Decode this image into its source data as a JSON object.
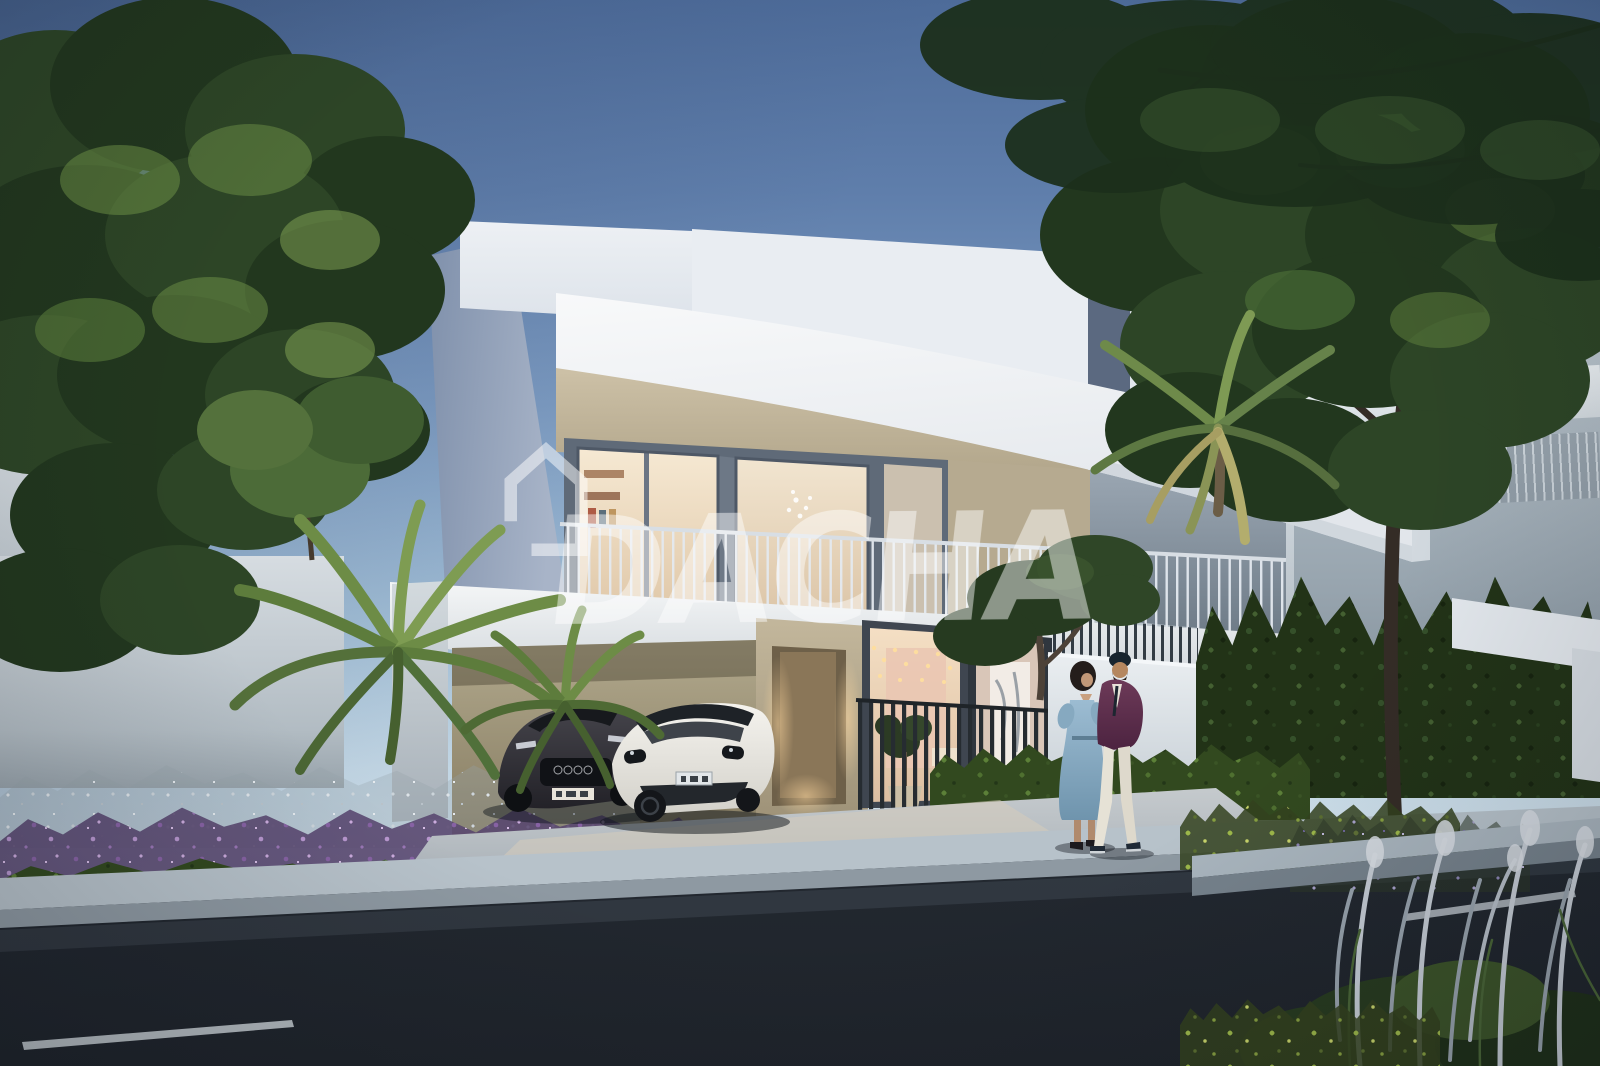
{
  "page": {
    "type": "architectural-rendering-photo",
    "description": "3D rendering of a modern three-storey white villa at dusk with warm lit interiors, a driveway with two parked cars, lush landscaping with purple flower beds and palms, a street in the foreground, large trees framing the scene and a couple walking on the sidewalk"
  },
  "watermark": {
    "logo_icon": "dacha-house-logo-icon",
    "text": "DACHA",
    "color": "#ffffff",
    "opacity": 0.4
  },
  "scene": {
    "time_of_day": "dusk",
    "villa": {
      "storeys": 3,
      "style": "contemporary",
      "features": [
        "stacked white volumes",
        "sweeping curved fascia band",
        "beige stone facade",
        "glass sliding doors with warm interior light",
        "balcony with thin vertical railing",
        "carport under balcony slab",
        "recessed entrance door",
        "string lights at entrance lounge",
        "dark vertical slat fence",
        "white gate wall"
      ]
    },
    "vehicles": [
      {
        "name": "white-sports-car",
        "color": "#efede7",
        "location": "driveway front"
      },
      {
        "name": "dark-grey-car",
        "color": "#35343a",
        "location": "driveway rear"
      }
    ],
    "people": [
      {
        "name": "woman",
        "outfit": "light blue midi dress, dark heels"
      },
      {
        "name": "man",
        "outfit": "plum blazer, white trousers, dark cap, dark shoes"
      }
    ],
    "landscape": [
      "large leafy tree left",
      "large leafy tree right with visible trunk",
      "palm tree right",
      "overhanging fern-like branches top right",
      "palm clusters by driveway",
      "purple flower bed",
      "white feather grasses",
      "clipped green hedges",
      "raised street planter with silver plume grasses"
    ],
    "street": [
      "dark asphalt road",
      "two white lane markings",
      "light concrete curb and sidewalk",
      "neighbouring white villas left and right"
    ]
  },
  "palette": {
    "sky_top": "#4d6b99",
    "sky_horizon": "#d9e7f0",
    "villa_white": "#eef0f3",
    "villa_shaded_side": "#8494ad",
    "facade_beige": "#c9bca2",
    "interior_warm": "#f2e2c6",
    "foliage_dark": "#24391f",
    "foliage_light": "#6f9447",
    "flower_purple": "#a487c0",
    "road_asphalt": "#262d35",
    "pavement": "#aeb9c2",
    "dress_blue": "#8fb2c8",
    "blazer_plum": "#5f2f4c"
  }
}
